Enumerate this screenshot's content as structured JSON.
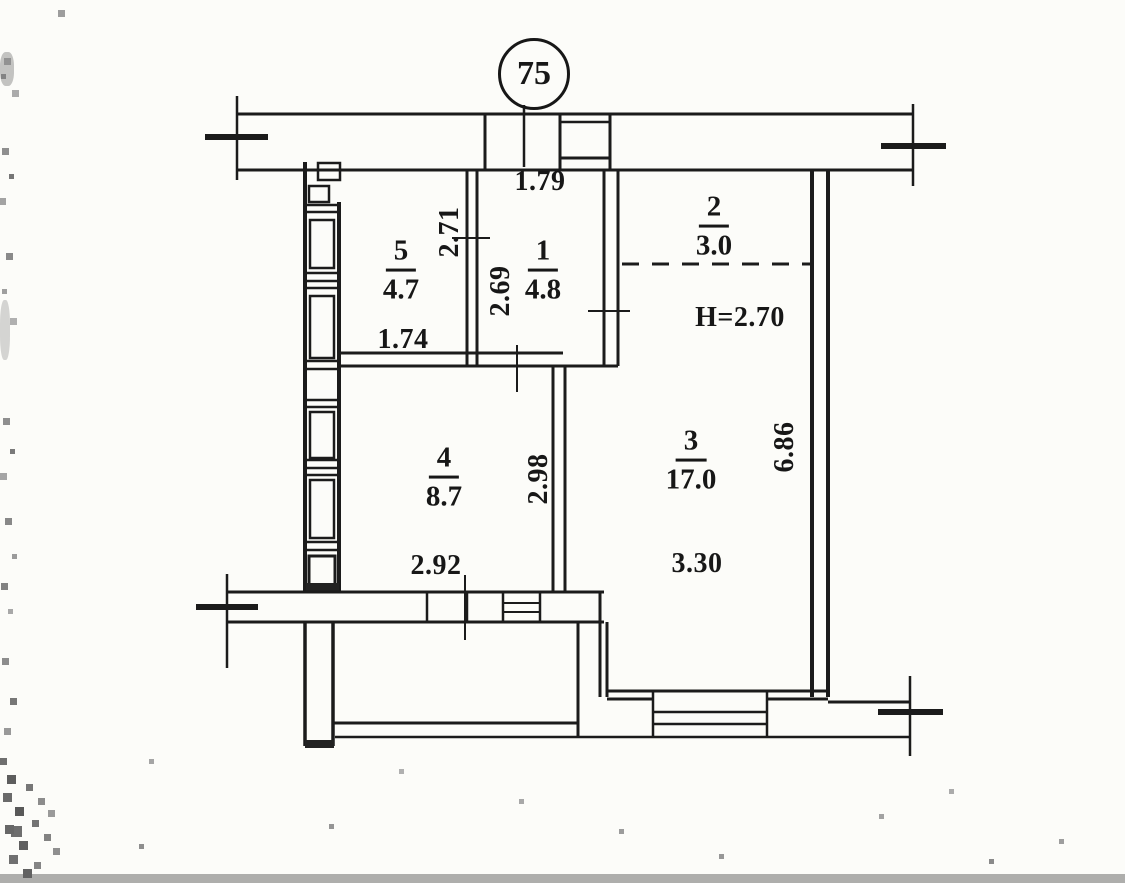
{
  "apartment_number": "75",
  "rooms": [
    {
      "number": "5",
      "area": "4.7"
    },
    {
      "number": "1",
      "area": "4.8"
    },
    {
      "number": "2",
      "area": "3.0"
    },
    {
      "number": "3",
      "area": "17.0"
    },
    {
      "number": "4",
      "area": "8.7"
    }
  ],
  "dimensions": {
    "room1_width": "1.79",
    "room5_depth": "2.71",
    "room1_depth": "2.69",
    "room5_width": "1.74",
    "room2_ceiling_height": "H=2.70",
    "room3_depth": "6.86",
    "room3_width": "3.30",
    "room4_depth": "2.98",
    "room4_width": "2.92"
  },
  "colors": {
    "ink": "#171717",
    "paper": "#fcfcf9"
  }
}
